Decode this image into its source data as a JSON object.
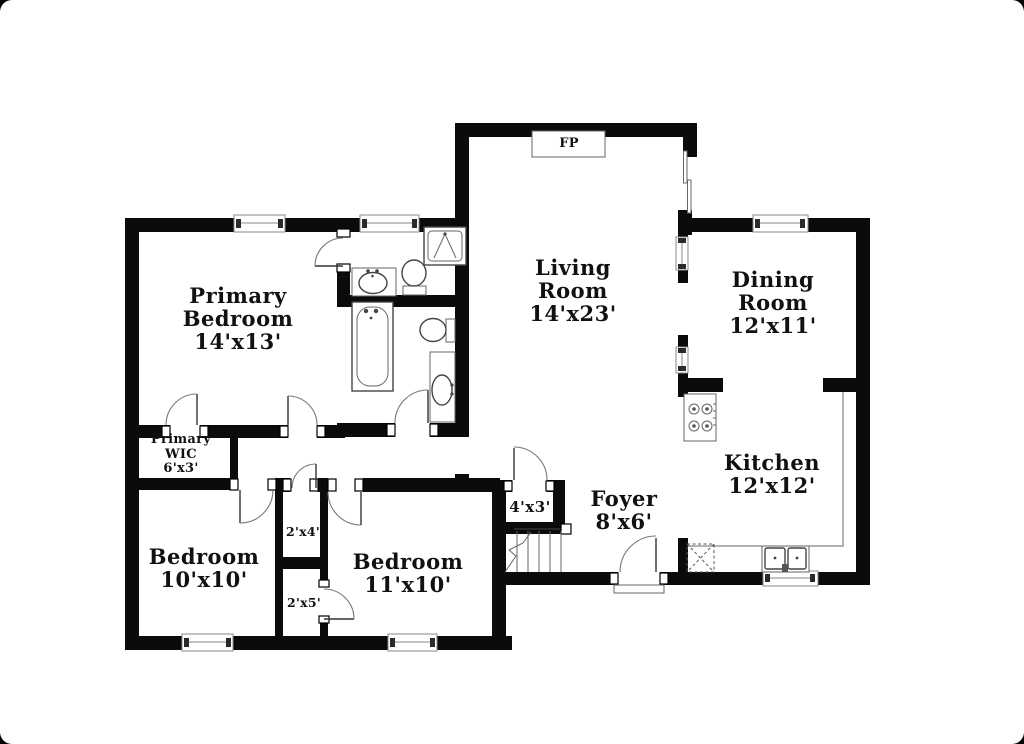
{
  "rooms": {
    "living": {
      "name1": "Living",
      "name2": "Room",
      "dims": "14'x23'"
    },
    "dining": {
      "name1": "Dining",
      "name2": "Room",
      "dims": "12'x11'"
    },
    "kitchen": {
      "name1": "Kitchen",
      "dims": "12'x12'"
    },
    "primary_bedroom": {
      "name1": "Primary",
      "name2": "Bedroom",
      "dims": "14'x13'"
    },
    "bedroom_left": {
      "name1": "Bedroom",
      "dims": "10'x10'"
    },
    "bedroom_mid": {
      "name1": "Bedroom",
      "dims": "11'x10'"
    },
    "foyer": {
      "name1": "Foyer",
      "dims": "8'x6'"
    },
    "primary_wic": {
      "name1": "Primary",
      "name2": "WIC",
      "dims": "6'x3'"
    },
    "closet_hall": {
      "dims": "4'x3'"
    },
    "closet_upper": {
      "dims": "2'x4'"
    },
    "closet_lower": {
      "dims": "2'x5'"
    }
  },
  "fireplace": {
    "label": "FP"
  },
  "fixtures": [
    "shower",
    "bathtub",
    "toilet",
    "vanity-sink",
    "stove",
    "kitchen-double-sink",
    "dishwasher",
    "stairs",
    "sliding-glass-door"
  ],
  "colors": {
    "wall": "#0b0b0b",
    "background": "#ffffff",
    "fixture_line": "#444444"
  }
}
